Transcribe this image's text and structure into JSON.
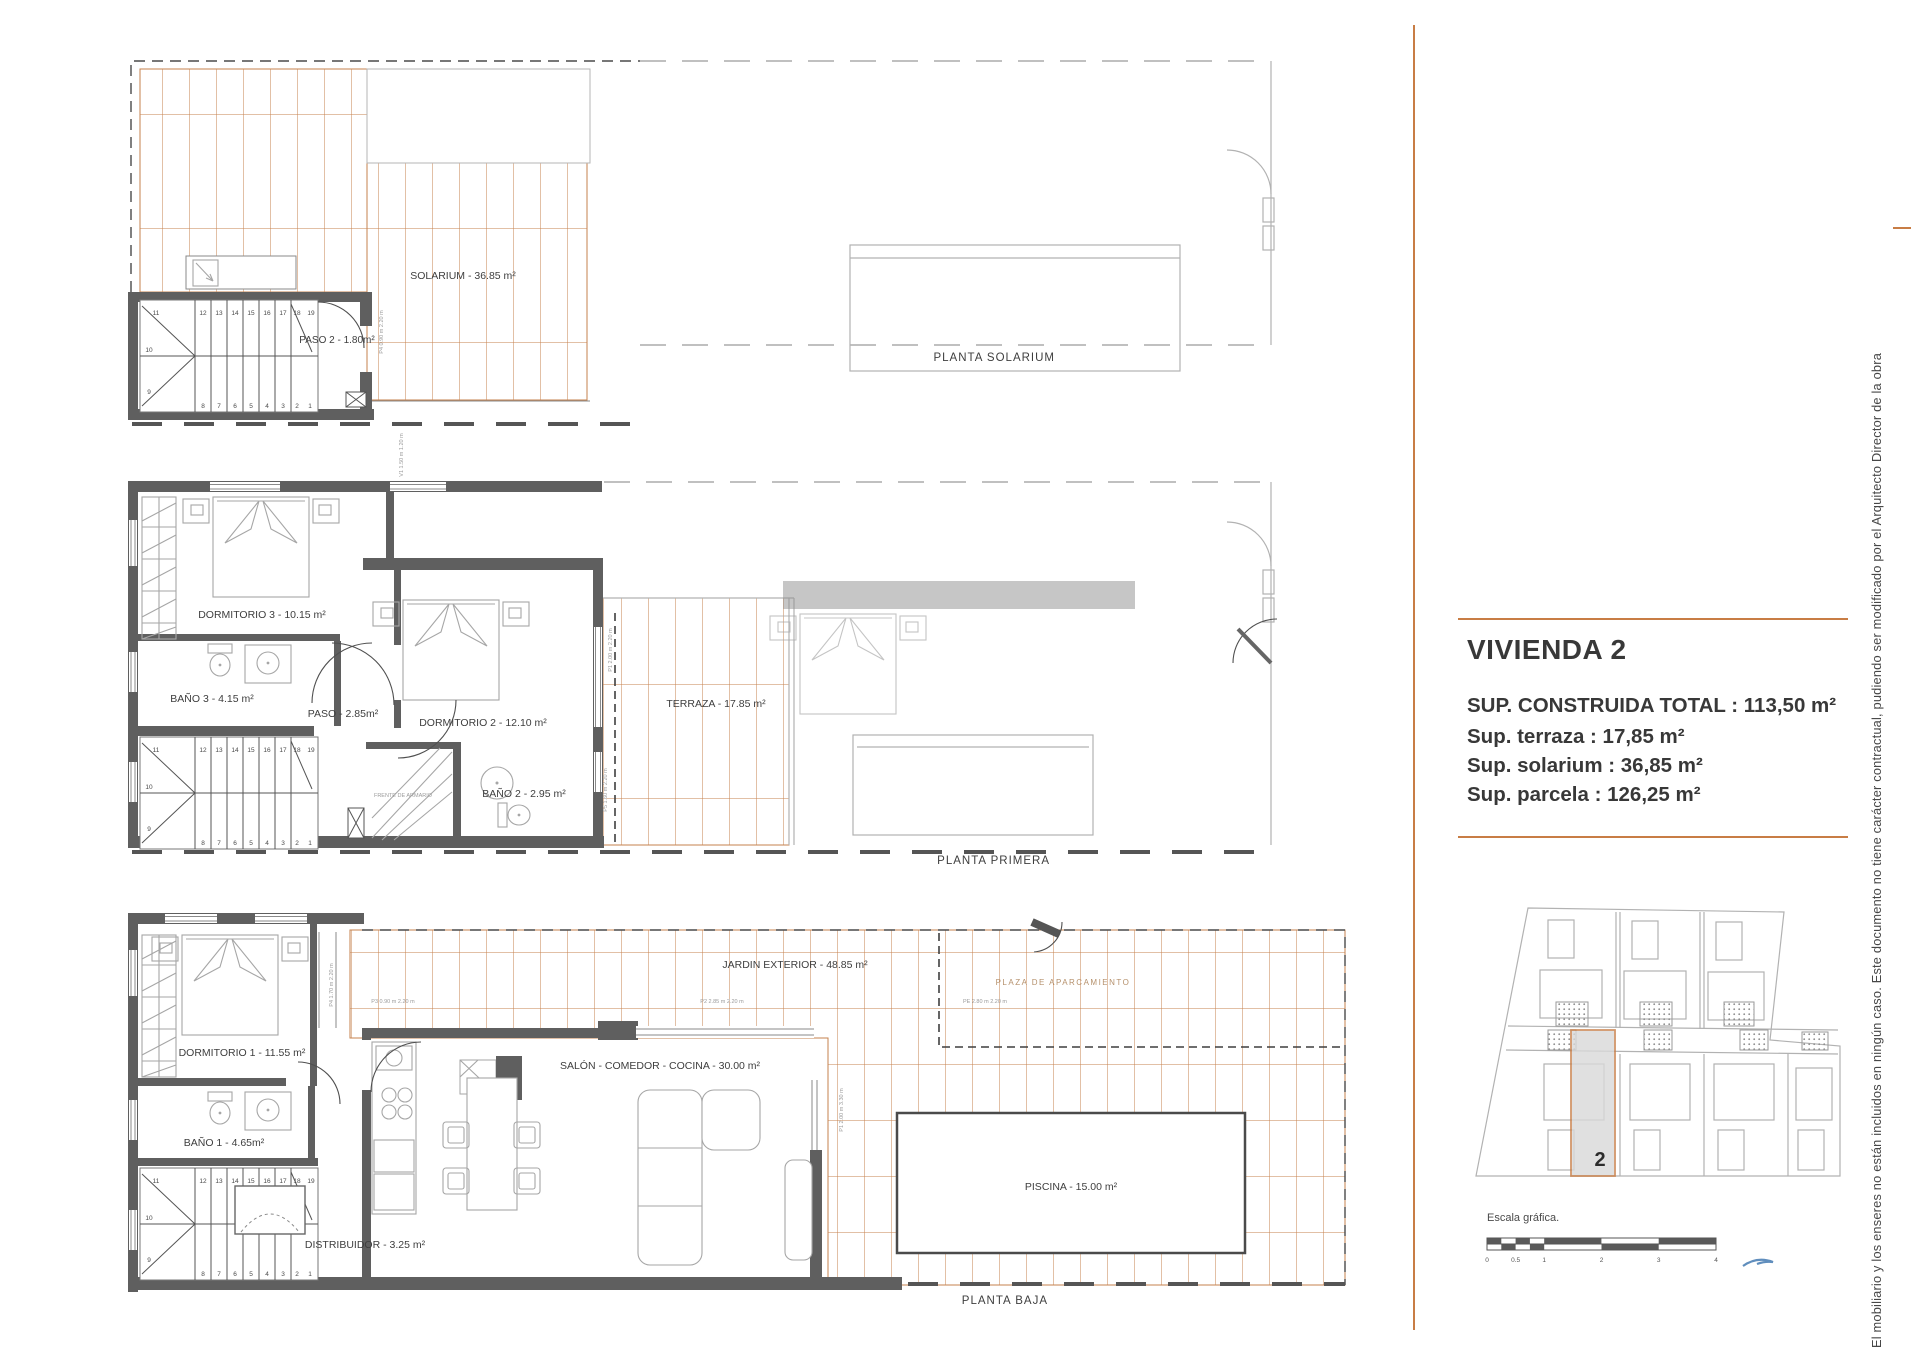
{
  "plans": {
    "solarium": {
      "title": "PLANTA SOLARIUM",
      "labels": {
        "solarium": "SOLARIUM - 36.85 m²",
        "paso2": "PASO 2 - 1.80m²"
      },
      "dims": {
        "p4": "P4  0.90 m  2.20 m"
      }
    },
    "primera": {
      "title": "PLANTA PRIMERA",
      "labels": {
        "dormitorio3": "DORMITORIO 3 - 10.15 m²",
        "bano3": "BAÑO 3 - 4.15 m²",
        "paso": "PASO - 2.85m²",
        "dormitorio2": "DORMITORIO 2 - 12.10 m²",
        "bano2": "BAÑO 2 - 2.95 m²",
        "terraza": "TERRAZA - 17.85 m²",
        "armario": "FRENTE DE ARMARIO"
      },
      "dims": {
        "v1": "V1  1.50 m  1.20 m",
        "p1": "P1  2.00 m  2.20 m",
        "p5": "P5  1.60 m  2.20 m"
      }
    },
    "baja": {
      "title": "PLANTA BAJA",
      "labels": {
        "dormitorio1": "DORMITORIO 1 - 11.55 m²",
        "bano1": "BAÑO 1 - 4.65m²",
        "distribuidor": "DISTRIBUIDOR - 3.25 m²",
        "salon": "SALÓN - COMEDOR - COCINA - 30.00 m²",
        "jardin": "JARDIN EXTERIOR - 48.85 m²",
        "plaza": "PLAZA DE APARCAMIENTO",
        "piscina": "PISCINA - 15.00 m²"
      },
      "dims": {
        "p4": "P4  1.70 m  2.20 m",
        "p3": "P3  0.90 m  2.20 m",
        "p2": "P2  2.85 m  2.20 m",
        "pe": "PE  2.80 m  2.20 m",
        "p1": "P1  2.00 m  3.30 m"
      }
    }
  },
  "stairs": {
    "steps": [
      "1",
      "2",
      "3",
      "4",
      "5",
      "6",
      "7",
      "8",
      "9",
      "10",
      "11",
      "12",
      "13",
      "14",
      "15",
      "16",
      "17",
      "18",
      "19"
    ]
  },
  "summary": {
    "title": "VIVIENDA 2",
    "lines": [
      "SUP. CONSTRUIDA TOTAL : 113,50 m²",
      "Sup. terraza : 17,85 m²",
      "Sup. solarium : 36,85 m²",
      "Sup. parcela : 126,25 m²"
    ]
  },
  "sitemap": {
    "unit_number": "2"
  },
  "scale": {
    "label": "Escala gráfica.",
    "ticks": [
      "0",
      "0.5",
      "1",
      "2",
      "3",
      "4"
    ]
  },
  "disclaimer": "El mobiliario y los enseres no están incluidos en ningún caso. Este documento no tiene carácter contractual, pudiendo ser modificado por el Arquitecto Director de la obra",
  "colors": {
    "tile": "#c5824e",
    "accent": "#c87d45",
    "wall": "#5f5f5f",
    "furniture": "#a6a6a6",
    "text": "#3e3e3e"
  }
}
